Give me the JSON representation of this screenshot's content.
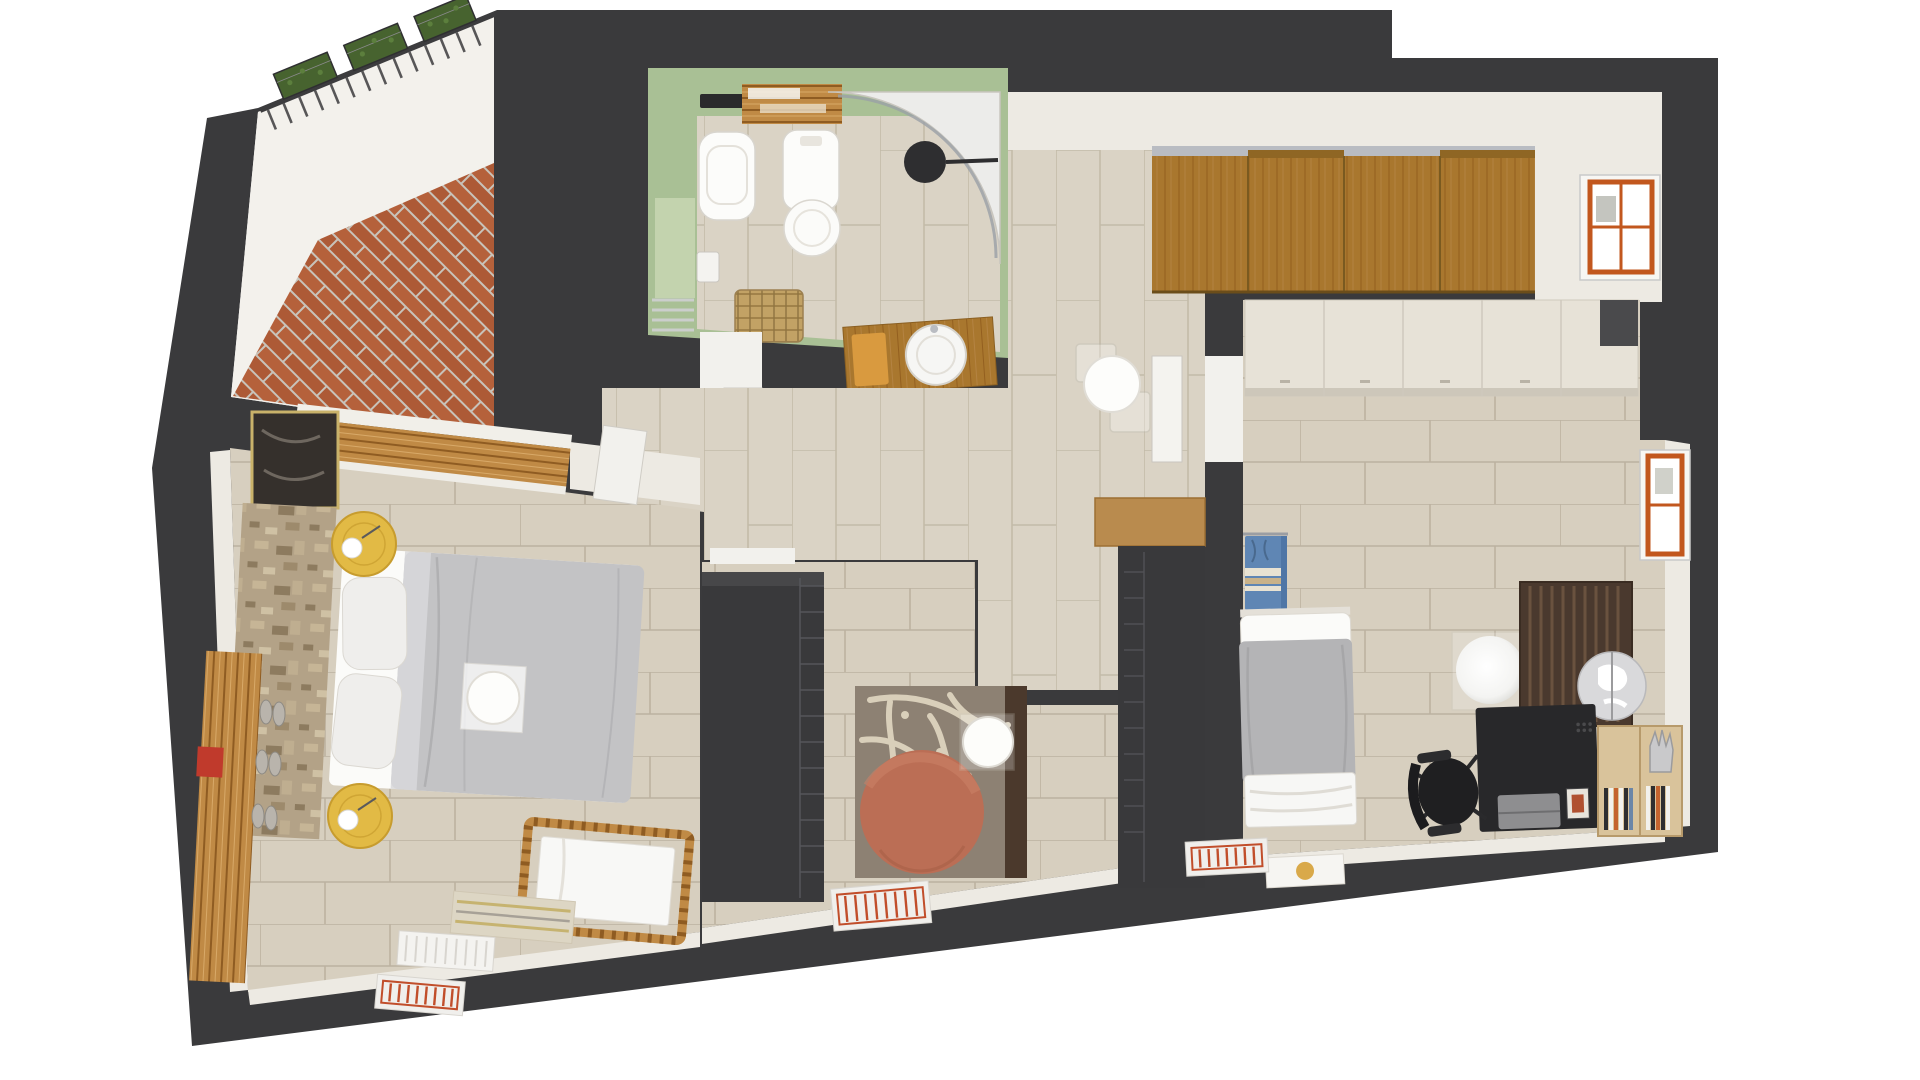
{
  "scene": {
    "kind": "3d-rendered-floor-plan-top-view",
    "rooms": {
      "terrace": {
        "items": [
          "brick-herringbone-paving",
          "guard-railing",
          "planter-boxes"
        ]
      },
      "bathroom": {
        "items": [
          "wall-hung-toilet",
          "bidet",
          "corner-shower",
          "shower-head",
          "vanity-sink",
          "orange-towel",
          "towel-shelves",
          "wicker-basket",
          "toilet-paper-holder",
          "wall-niche",
          "vent-grille"
        ]
      },
      "hallway": {
        "items": [
          "sliding-wardrobe",
          "round-table",
          "acrylic-chairs",
          "open-door",
          "window",
          "wood-console"
        ]
      },
      "bedroom-left": {
        "items": [
          "double-bed",
          "pillows",
          "breakfast-tray",
          "round-nightstand-with-lamp-top",
          "round-nightstand-with-lamp-bottom",
          "stone-accent-wall",
          "artwork",
          "louver-window",
          "baby-crib",
          "wood-bench",
          "shoes",
          "red-box",
          "striped-rug",
          "white-radiator-mat",
          "orange-floor-grille"
        ]
      },
      "dressing-room": {
        "items": [
          "wardrobe-unit-west",
          "wardrobe-unit-east",
          "wood-console-cap",
          "floral-rug",
          "terracotta-ottoman",
          "glass-side-table",
          "orange-floor-grille"
        ]
      },
      "bedroom-right": {
        "items": [
          "built-in-wardrobe",
          "single-bed",
          "blue-wall-towels",
          "desk",
          "laptop",
          "photo-frame",
          "office-chair",
          "globe",
          "sphere-lamp",
          "slat-bookcase",
          "corner-bookshelf",
          "books",
          "hand-sculpture",
          "window",
          "floor-mat-gold-logo",
          "orange-floor-grille"
        ]
      }
    }
  },
  "colors": {
    "wall": "#3a3a3c",
    "wall_face": "#edeae3",
    "terrace_floor": "#f3f1ec",
    "terrace_brick": "#b5613b",
    "bath_green": "#a9c095",
    "bath_green_light": "#c3d3ae",
    "floor_tile": "#d9d2c3",
    "floor_tile_large": "#d7cfbf",
    "wood": "#a9772e",
    "wood_light": "#c08a45",
    "gray_track": "#b9bcc2",
    "cream_cabinet": "#e7e2d7",
    "duvet": "#c3c3c5",
    "duvet_single": "#b4b4b6",
    "pillow": "#efeeec",
    "sheet": "#fbfbf9",
    "nightstand_yellow": "#e2ba45",
    "ottoman": "#bb6e55",
    "rug": "#8d8173",
    "rug_pattern": "#d9cfba",
    "rug_dark": "#4b392c",
    "towel_blue": "#5f86b4",
    "towel_stripe": "#c9b289",
    "window_orange": "#c2571e",
    "dark_unit": "#39393b",
    "desk": "#28282a",
    "chair": "#1f1f21",
    "stone": "#b3a287",
    "radiator_orange": "#c14e2b",
    "radiator_frame": "#f0efec",
    "basket": "#c2a265",
    "plant": "#47632f",
    "shower_head": "#2e2e30",
    "globe": "#d9d9db",
    "shelf_brown": "#4a392e",
    "sink_towel": "#d99a3f",
    "red_box": "#c03a2c",
    "gold": "#d9a94a"
  }
}
